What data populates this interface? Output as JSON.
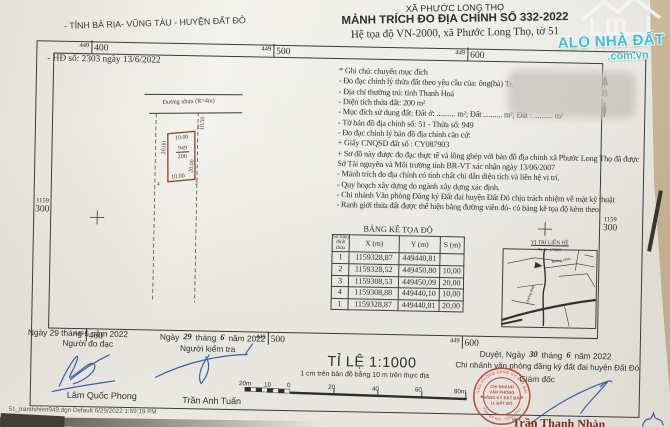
{
  "colors": {
    "paper": "#f1efe9",
    "background_beige": "#c9b794",
    "ink": "#2d2d30",
    "parcel_red": "#8a4034",
    "stamp_red": "#c13a30",
    "signature_blue": "#2c49a3",
    "watermark_cyan": "#3fc6de"
  },
  "header": {
    "province": "- TỈNH BÀ RỊA- VŨNG TÀU - HUYỆN ĐẤT ĐỎ",
    "commune": "XÃ PHƯỚC LONG THỌ",
    "title": "MẢNH TRÍCH ĐO ĐỊA CHÍNH SỐ  332-2022",
    "coord_system": "Hệ tọa độ VN-2000, xã Phước Long Thọ, tờ 51"
  },
  "watermark": {
    "line1": "ALO NHÀ ĐẤT",
    "line2": ".com.vn"
  },
  "contract": "- HĐ số: 2303 ngày 13/6/2022",
  "map": {
    "grid": {
      "prefix_x": "449",
      "x_values": [
        "400",
        "500",
        "600"
      ],
      "prefix_y": "1159",
      "y_value": "300"
    },
    "road_label": "Đường nhựa (R>4m)",
    "north_label": "B",
    "parcel": {
      "number": "949",
      "area": "200",
      "dim_top": "10.00",
      "dim_left": "20.00",
      "dim_right": "20.00",
      "dim_bottom": "10.00",
      "dim_gap": "10.50",
      "corner2": "2",
      "corner3": "3",
      "corner4": "4"
    },
    "vicinity": {
      "title": "VỊ TRÍ LIÊN HỆ",
      "scale": "Tỷ lệ: 1/5000",
      "road_label": "Đường nhựa"
    }
  },
  "notes": {
    "items": [
      "* Ghi chú: chuyển mục đích",
      "- Đo đạc chỉnh lý thửa đất theo yêu cầu của:  ông(bà) Tr.",
      "- Địa chỉ thường trú: tỉnh Thanh Hoá",
      "- Diện tích thửa đất: 200 m²",
      "- Mục đích sử dụng đất: Đất ở: .......... m²; Đất .......... m²; Đất : .......... m²",
      "- Tờ bản đồ địa chính số:        51      - Thửa số:    949",
      "- Đo đạc chỉnh lý bản đồ địa chính căn cứ:",
      "+ Giấy CNQSD đất số :   CY087903",
      "+ Sơ đồ này được đo đạc thực tế và lồng ghép với bản đồ địa chính xã Phước Long Thọ đã được Sở Tài nguyên và Môi trường tỉnh BR-VT xác nhận ngày 13/06/2007",
      "- Mảnh trích đo địa chính có tính chất chỉ dẫn diện tích và liên hệ vị trí.",
      "- Quy hoạch xây dựng do ngành xây dựng xác định.",
      "- Chi nhánh Văn phòng Đăng ký Đất đai huyện Đất Đỏ chịu trách nhiệm về mặt kỹ thuật",
      "- Ranh giới thửa đất được thể hiện bằng đường viền đỏ- có bảng kê tọa độ kèm theo"
    ]
  },
  "table": {
    "title": "BẢNG KÊ TỌA ĐỘ",
    "headers": [
      "Số hiệu đỉnh thửa",
      "X (m)",
      "Y (m)",
      "S (m)"
    ],
    "rows": [
      [
        "1",
        "1159328,87",
        "449440,81",
        ""
      ],
      [
        "2",
        "1159328,52",
        "449450,80",
        "10,00"
      ],
      [
        "3",
        "1159308,53",
        "449450,09",
        "20,00"
      ],
      [
        "4",
        "1159308,88",
        "449440,10",
        "10,00"
      ],
      [
        "1",
        "1159328,87",
        "449440,81",
        "20,00"
      ]
    ]
  },
  "scale": {
    "title": "TỈ LỆ 1:1000",
    "note": "1 cm trên bản đồ bằng 10 m trên thực địa",
    "left_ticks": [
      "20m",
      "10",
      "0"
    ],
    "right_ticks": [
      "20",
      "40",
      "60",
      "80m"
    ]
  },
  "signatures": {
    "surveyor": {
      "date": "Ngày 29 tháng  6  năm  2022",
      "role": "Người đo đạc",
      "name": "Lâm Quốc Phong"
    },
    "checker": {
      "date_parts": [
        "Ngày",
        "29",
        "tháng",
        "6",
        "năm  2022"
      ],
      "role": "Người kiểm tra",
      "name": "Trần Anh Tuấn"
    },
    "approver": {
      "date_parts": [
        "Duyệt, Ngày",
        "30",
        "tháng",
        "6",
        "năm 2022"
      ],
      "org": "Chi nhánh văn phòng đăng ký đất đai huyện Đất Đỏ",
      "role": "Giám đốc",
      "name": "Trần Thanh Nhàn"
    }
  },
  "stamp": {
    "ring_top": "VĂN PHÒNG ĐĂNG KÝ ĐẤT ĐAI",
    "ring_bottom": "TỈNH BÀ RỊA - VŨNG TÀU",
    "star": "★",
    "lines": [
      "CHI NHÁNH",
      "VĂN PHÒNG",
      "ĐĂNG KÝ ĐẤT ĐAI",
      "H. ĐẤT ĐỎ"
    ]
  },
  "footer": "51_tranthihien949.dgn Default 6/29/2022 1:59:19 PM"
}
